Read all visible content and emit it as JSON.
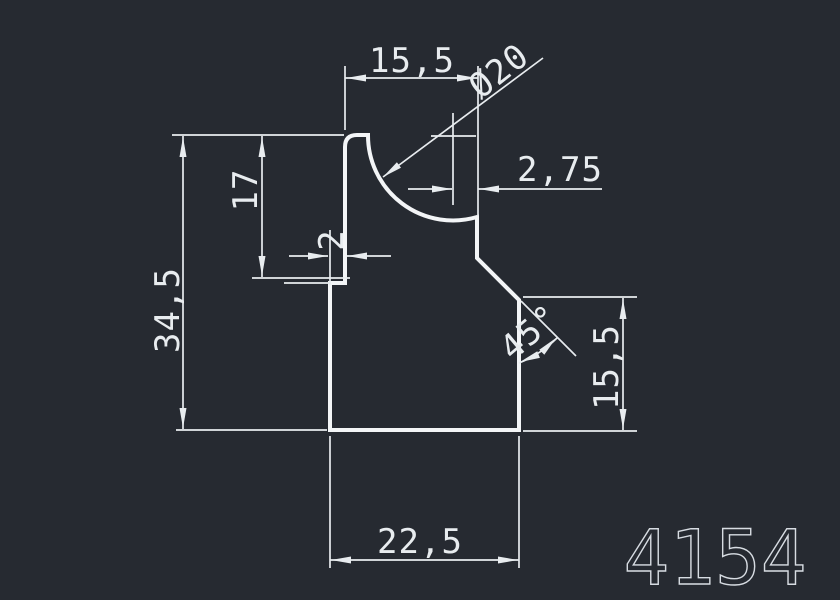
{
  "colors": {
    "background": "#262a31",
    "profile_line": "#f3f5f7",
    "dimension_line": "#e8ecef",
    "part_number_color": "#d7dce2"
  },
  "drawing": {
    "type": "CAD profile cross-section drawing",
    "dimensions": {
      "top_width": "15,5",
      "diameter": "Ø20",
      "center_offset": "2,75",
      "upper_left_height": "17",
      "step_width": "2",
      "total_height": "34,5",
      "chamfer_angle": "45°",
      "right_height": "15,5",
      "bottom_width": "22,5"
    },
    "part_number": "4154"
  }
}
